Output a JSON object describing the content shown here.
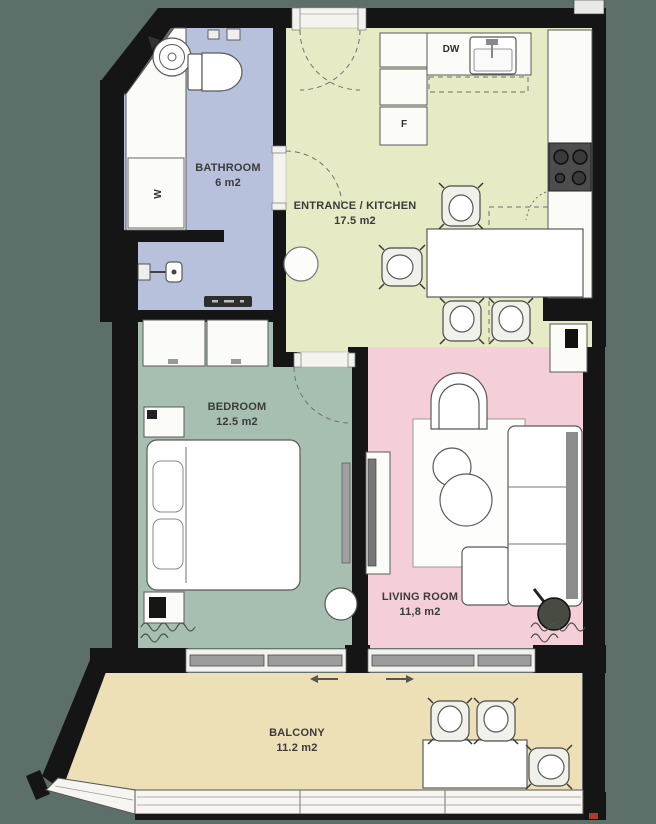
{
  "plan": {
    "rooms": {
      "bathroom": {
        "name": "BATHROOM",
        "area": "6 m2"
      },
      "entrance_kitchen": {
        "name": "ENTRANCE / KITCHEN",
        "area": "17.5 m2"
      },
      "bedroom": {
        "name": "BEDROOM",
        "area": "12.5 m2"
      },
      "living_room": {
        "name": "LIVING ROOM",
        "area": "11,8 m2"
      },
      "balcony": {
        "name": "BALCONY",
        "area": "11.2 m2"
      }
    },
    "appliances": {
      "dishwasher": "DW",
      "freezer": "F",
      "washer": "W"
    },
    "colors": {
      "background": "#5C6F68",
      "wall": "#151515",
      "bathroom_floor": "#B7C1DC",
      "kitchen_floor": "#E6EAC5",
      "bedroom_floor": "#A6BFB1",
      "living_floor": "#F4CFD7",
      "balcony_floor": "#EDDFB6",
      "window_bar": "#9C9C9C",
      "label_text": "#3B3B3B",
      "marker_red": "#B0392E"
    }
  }
}
